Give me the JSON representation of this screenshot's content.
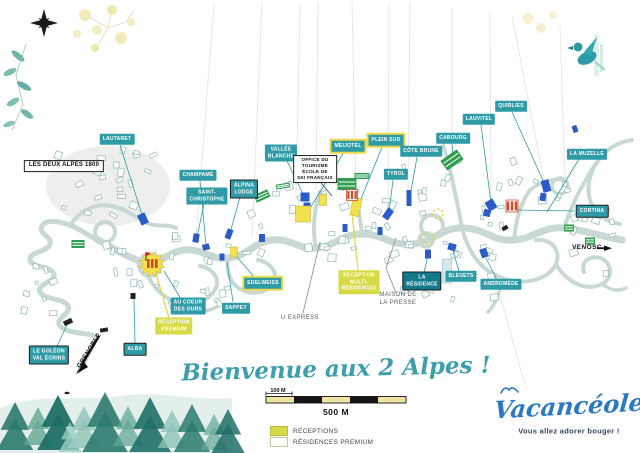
{
  "welcome": {
    "text": "Bienvenue aux 2 Alpes !"
  },
  "scale": {
    "minor": "100 M",
    "major": "500 M"
  },
  "legend": {
    "items": [
      {
        "key": "receptions",
        "label": "RÉCEPTIONS"
      },
      {
        "key": "premium",
        "label": "RÉSIDENCES PREMIUM"
      }
    ]
  },
  "logo": {
    "name": "Vacancéole",
    "tagline": "Vous allez adorer bouger !"
  },
  "colors": {
    "teal_label": "#2E9BA6",
    "teal_dark_label": "#11798A",
    "reception_label": "#D6DA45",
    "premium_border": "#EDD94C",
    "road": "#C7D8D5",
    "blue_marker": "#2A5BC8",
    "green_marker": "#2F9E4F",
    "orange_marker": "#D9472B",
    "yellow_marker": "#F2E14F",
    "script_teal": "#3D9FAC",
    "logo_blue": "#2B79C2",
    "scale_cream": "#EDE3A3"
  },
  "map": {
    "labels": [
      {
        "id": "lautaret",
        "text": "LAUTARET",
        "type": "teal",
        "x": 117,
        "y": 139,
        "leader": [
          [
            120,
            145
          ],
          [
            143,
            218
          ]
        ]
      },
      {
        "id": "champame",
        "text": "CHAMPAMÉ",
        "type": "teal",
        "x": 198,
        "y": 175,
        "leader": [
          [
            200,
            181
          ],
          [
            206,
            245
          ]
        ]
      },
      {
        "id": "saint-christophe",
        "text": "SAINT-\nCHRISTOPHE",
        "type": "teal",
        "x": 207,
        "y": 196,
        "leader": [
          [
            204,
            204
          ],
          [
            197,
            237
          ]
        ]
      },
      {
        "id": "alpina-lodge",
        "text": "ALPINA\nLODGE",
        "type": "teal-b",
        "x": 244,
        "y": 189,
        "leader": [
          [
            240,
            197
          ],
          [
            230,
            233
          ]
        ]
      },
      {
        "id": "vallee-blanche",
        "text": "VALLÉE\nBLANCHE",
        "type": "teal",
        "x": 281,
        "y": 153,
        "leader": [
          [
            287,
            161
          ],
          [
            304,
            196
          ]
        ]
      },
      {
        "id": "meijotel",
        "text": "MEIJOTEL",
        "type": "premium",
        "x": 348,
        "y": 146,
        "leader": [
          [
            344,
            152
          ],
          [
            309,
            210
          ]
        ]
      },
      {
        "id": "plein-sud",
        "text": "PLEIN SUD",
        "type": "premium",
        "x": 386,
        "y": 140,
        "leader": [
          [
            382,
            147
          ],
          [
            359,
            204
          ]
        ]
      },
      {
        "id": "cote-brune",
        "text": "CÔTE BRUNE",
        "type": "teal",
        "x": 421,
        "y": 151,
        "leader": [
          [
            417,
            157
          ],
          [
            410,
            197
          ]
        ]
      },
      {
        "id": "tyrol",
        "text": "TYROL",
        "type": "teal",
        "x": 396,
        "y": 174,
        "leader": [
          [
            393,
            180
          ],
          [
            389,
            212
          ]
        ]
      },
      {
        "id": "cabourg",
        "text": "CABOURG",
        "type": "teal",
        "x": 453,
        "y": 138,
        "leader": [
          [
            452,
            144
          ],
          [
            453,
            158
          ]
        ]
      },
      {
        "id": "lauvitel",
        "text": "LAUVITEL",
        "type": "teal",
        "x": 479,
        "y": 119,
        "leader": [
          [
            481,
            125
          ],
          [
            491,
            203
          ]
        ]
      },
      {
        "id": "quirlies",
        "text": "QUIRLIES",
        "type": "teal",
        "x": 511,
        "y": 106,
        "leader": [
          [
            512,
            112
          ],
          [
            545,
            185
          ]
        ]
      },
      {
        "id": "la-muzelle",
        "text": "LA MUZELLE",
        "type": "teal",
        "x": 587,
        "y": 154,
        "leader": [
          [
            579,
            159
          ],
          [
            547,
            212
          ]
        ]
      },
      {
        "id": "cortina",
        "text": "CORTINA",
        "type": "teal-b",
        "x": 592,
        "y": 211,
        "leader": [
          [
            575,
            211
          ],
          [
            518,
            210
          ]
        ]
      },
      {
        "id": "office-tourisme",
        "text": "OFFICE DU\nTOURISME\nÉCOLE DE\nSKI FRANÇAIS",
        "type": "white",
        "x": 315,
        "y": 169,
        "leader": [
          [
            321,
            183
          ],
          [
            332,
            196
          ]
        ]
      },
      {
        "id": "les-deux-alpes-1800",
        "text": "LES DEUX ALPES 1800",
        "type": "white-lg",
        "x": 64,
        "y": 166
      },
      {
        "id": "edelweiss",
        "text": "EDELWEISS",
        "type": "premium",
        "x": 263,
        "y": 283,
        "leader": [
          [
            256,
            279
          ],
          [
            237,
            257
          ]
        ]
      },
      {
        "id": "sappey",
        "text": "SAPPEY",
        "type": "teal",
        "x": 236,
        "y": 308,
        "leader": [
          [
            233,
            302
          ],
          [
            227,
            262
          ]
        ]
      },
      {
        "id": "au-coeur-des-ours",
        "text": "AU COEUR\nDES OURS",
        "type": "teal",
        "x": 188,
        "y": 306,
        "leader": [
          [
            181,
            299
          ],
          [
            164,
            271
          ]
        ]
      },
      {
        "id": "reception-premium",
        "text": "RÉCEPTION\nPREMIUM",
        "type": "reception",
        "x": 174,
        "y": 326,
        "leader": [
          [
            169,
            318
          ],
          [
            155,
            270
          ]
        ]
      },
      {
        "id": "alba",
        "text": "ALBA",
        "type": "teal-b",
        "x": 135,
        "y": 349,
        "leader": [
          [
            135,
            343
          ],
          [
            134,
            299
          ]
        ]
      },
      {
        "id": "le-goleon-val-ecrins",
        "text": "LE GOLÉON\nVAL ÉCRINS",
        "type": "teal-b",
        "x": 49,
        "y": 355,
        "leader": [
          [
            56,
            348
          ],
          [
            67,
            325
          ]
        ]
      },
      {
        "id": "reception-multi",
        "text": "RÉCEPTION\nMULTI-\nRÉSIDENCES",
        "type": "reception",
        "x": 359,
        "y": 282,
        "leader": [
          [
            358,
            270
          ],
          [
            352,
            212
          ]
        ]
      },
      {
        "id": "maison-de-la-presse",
        "text": "MAISON DE\nLA PRESSE",
        "type": "plain",
        "x": 398,
        "y": 300,
        "leader": [
          [
            396,
            293
          ],
          [
            386,
            268
          ],
          [
            396,
            238
          ]
        ]
      },
      {
        "id": "la-residence",
        "text": "LA\nRÉSIDENCE",
        "type": "teal-dark",
        "x": 422,
        "y": 281,
        "leader": [
          [
            424,
            273
          ],
          [
            429,
            250
          ]
        ]
      },
      {
        "id": "bleuets",
        "text": "BLEUETS",
        "type": "teal",
        "x": 461,
        "y": 276,
        "leader": [
          [
            459,
            271
          ],
          [
            453,
            251
          ]
        ]
      },
      {
        "id": "andromede",
        "text": "ANDROMÈDE",
        "type": "teal",
        "x": 501,
        "y": 284,
        "leader": [
          [
            497,
            280
          ],
          [
            486,
            258
          ]
        ]
      },
      {
        "id": "u-express",
        "text": "U EXPRESS",
        "type": "plain",
        "x": 300,
        "y": 319,
        "leader": [
          [
            303,
            313
          ],
          [
            320,
            242
          ]
        ]
      },
      {
        "id": "venosc",
        "text": "VENOSC",
        "type": "plain-bold",
        "x": 587,
        "y": 248
      },
      {
        "id": "grenoble",
        "text": "GRENOBLE",
        "type": "plain-bold",
        "x": 90,
        "y": 351,
        "rot": -58
      }
    ],
    "markers": [
      {
        "type": "blue",
        "x": 143,
        "y": 219,
        "w": 8,
        "h": 11,
        "rot": -25
      },
      {
        "type": "blue",
        "x": 196,
        "y": 238,
        "w": 6,
        "h": 9,
        "rot": 10
      },
      {
        "type": "blue",
        "x": 206,
        "y": 247,
        "w": 7,
        "h": 6,
        "rot": -15
      },
      {
        "type": "blue",
        "x": 229,
        "y": 234,
        "w": 6,
        "h": 10,
        "rot": 20
      },
      {
        "type": "blue",
        "x": 305,
        "y": 197,
        "w": 9,
        "h": 9,
        "rot": 0
      },
      {
        "type": "blue",
        "x": 307,
        "y": 207,
        "w": 7,
        "h": 9,
        "rot": 0
      },
      {
        "type": "blue",
        "x": 388,
        "y": 214,
        "w": 7,
        "h": 11,
        "rot": 35
      },
      {
        "type": "blue",
        "x": 409,
        "y": 198,
        "w": 5,
        "h": 16,
        "rot": 0
      },
      {
        "type": "blue",
        "x": 380,
        "y": 231,
        "w": 5,
        "h": 8,
        "rot": 0
      },
      {
        "type": "blue",
        "x": 491,
        "y": 205,
        "w": 9,
        "h": 10,
        "rot": -30
      },
      {
        "type": "blue",
        "x": 487,
        "y": 213,
        "w": 7,
        "h": 7,
        "rot": 15
      },
      {
        "type": "blue",
        "x": 546,
        "y": 186,
        "w": 8,
        "h": 12,
        "rot": -15
      },
      {
        "type": "blue",
        "x": 543,
        "y": 197,
        "w": 6,
        "h": 8,
        "rot": 10
      },
      {
        "type": "blue",
        "x": 452,
        "y": 247,
        "w": 8,
        "h": 7,
        "rot": 15
      },
      {
        "type": "blue",
        "x": 484,
        "y": 253,
        "w": 7,
        "h": 9,
        "rot": -20
      },
      {
        "type": "blue",
        "x": 262,
        "y": 238,
        "w": 6,
        "h": 8,
        "rot": 0
      },
      {
        "type": "blue",
        "x": 222,
        "y": 257,
        "w": 5,
        "h": 7,
        "rot": 0
      },
      {
        "type": "blue",
        "x": 345,
        "y": 228,
        "w": 5,
        "h": 8,
        "rot": 0
      },
      {
        "type": "blue",
        "x": 428,
        "y": 254,
        "w": 6,
        "h": 9,
        "rot": 0
      },
      {
        "type": "blue",
        "x": 575,
        "y": 129,
        "w": 5,
        "h": 7,
        "rot": -20
      },
      {
        "type": "yellow",
        "x": 303,
        "y": 214,
        "w": 15,
        "h": 16,
        "rot": 0
      },
      {
        "type": "yellow",
        "x": 356,
        "y": 207,
        "w": 9,
        "h": 18,
        "rot": 12
      },
      {
        "type": "yellow",
        "x": 234,
        "y": 252,
        "w": 7,
        "h": 10,
        "rot": 0
      },
      {
        "type": "yellow",
        "x": 323,
        "y": 200,
        "w": 7,
        "h": 11,
        "rot": 0
      },
      {
        "type": "green",
        "x": 452,
        "y": 160,
        "w": 20,
        "h": 12,
        "rot": -35
      },
      {
        "type": "green",
        "x": 347,
        "y": 184,
        "w": 19,
        "h": 12,
        "rot": 0
      },
      {
        "type": "green",
        "x": 362,
        "y": 176,
        "w": 15,
        "h": 6,
        "rot": 0
      },
      {
        "type": "green",
        "x": 283,
        "y": 186,
        "w": 14,
        "h": 5,
        "rot": -10
      },
      {
        "type": "green",
        "x": 262,
        "y": 196,
        "w": 15,
        "h": 8,
        "rot": -25
      },
      {
        "type": "green",
        "x": 78,
        "y": 244,
        "w": 13,
        "h": 8,
        "rot": 0
      },
      {
        "type": "green",
        "x": 569,
        "y": 228,
        "w": 10,
        "h": 7,
        "rot": 0
      },
      {
        "type": "green",
        "x": 590,
        "y": 241,
        "w": 10,
        "h": 7,
        "rot": 0
      },
      {
        "type": "orange",
        "x": 352,
        "y": 195,
        "w": 11,
        "h": 11,
        "rot": 0
      },
      {
        "type": "orange",
        "x": 512,
        "y": 206,
        "w": 12,
        "h": 12,
        "rot": 0
      },
      {
        "type": "lightblue",
        "x": 447,
        "y": 271,
        "w": 9,
        "h": 24,
        "rot": 0
      },
      {
        "type": "black",
        "x": 68,
        "y": 322,
        "w": 9,
        "h": 5,
        "rot": -25
      },
      {
        "type": "black",
        "x": 104,
        "y": 330,
        "w": 8,
        "h": 4,
        "rot": -10
      },
      {
        "type": "black",
        "x": 200,
        "y": 306,
        "w": 7,
        "h": 4,
        "rot": 15
      },
      {
        "type": "black",
        "x": 133,
        "y": 296,
        "w": 5,
        "h": 6,
        "rot": 0
      },
      {
        "type": "black",
        "x": 505,
        "y": 228,
        "w": 6,
        "h": 4,
        "rot": -30
      },
      {
        "type": "dash-circle",
        "x": 438,
        "y": 214,
        "w": 10,
        "h": 10,
        "rot": 0
      },
      {
        "type": "dash-circle",
        "x": 428,
        "y": 238,
        "w": 12,
        "h": 12,
        "rot": 0
      },
      {
        "type": "reception-star",
        "x": 152,
        "y": 264,
        "w": 26,
        "h": 26,
        "rot": 0
      }
    ]
  }
}
